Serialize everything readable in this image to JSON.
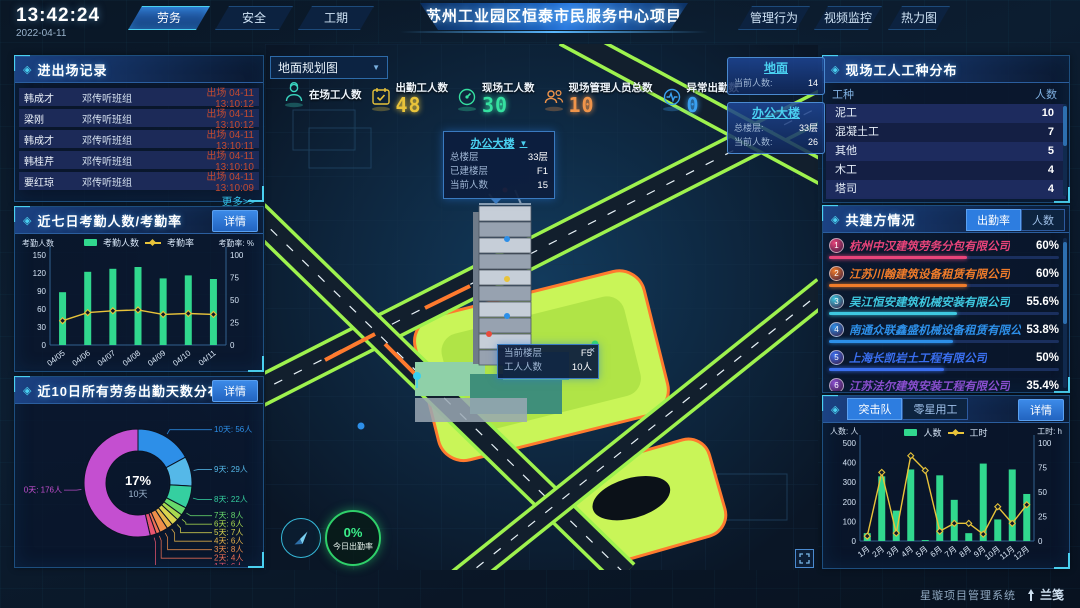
{
  "topbar": {
    "time": "13:42:24",
    "date": "2022-04-11",
    "left_tabs": [
      {
        "label": "劳务",
        "active": true
      },
      {
        "label": "安全",
        "active": false
      },
      {
        "label": "工期",
        "active": false
      }
    ],
    "title": "苏州工业园区恒泰市民服务中心项目",
    "right_tabs": [
      "管理行为",
      "视频监控",
      "热力图"
    ]
  },
  "entry_exit": {
    "title": "进出场记录",
    "more_label": "更多>>",
    "rows": [
      {
        "name": "韩成才",
        "group": "邓传听班组",
        "event": "出场 04-11 13:10:12"
      },
      {
        "name": "梁刚",
        "group": "邓传听班组",
        "event": "出场 04-11 13:10:12"
      },
      {
        "name": "韩成才",
        "group": "邓传听班组",
        "event": "出场 04-11 13:10:11"
      },
      {
        "name": "韩桂芹",
        "group": "邓传听班组",
        "event": "出场 04-11 13:10:10"
      },
      {
        "name": "要红琼",
        "group": "邓传听班组",
        "event": "出场 04-11 13:10:09"
      }
    ]
  },
  "panels": {
    "attendance": {
      "title": "近七日考勤人数/考勤率",
      "detail": "详情"
    },
    "distribution": {
      "title": "近10日所有劳务出勤天数分布",
      "detail": "详情"
    }
  },
  "map": {
    "layer_select": "地面规划图",
    "stats": [
      {
        "label": "在场工人数",
        "value": "",
        "color": "#3ad6c0",
        "icon": "worker-icon"
      },
      {
        "label": "出勤工人数",
        "value": "48",
        "color": "#e8c33a",
        "icon": "calendar-icon"
      },
      {
        "label": "现场工人数",
        "value": "30",
        "color": "#35e0a0",
        "icon": "gauge-icon"
      },
      {
        "label": "现场管理人员总数",
        "value": "10",
        "color": "#f0944a",
        "icon": "people-icon"
      },
      {
        "label": "异常出勤数",
        "value": "0",
        "color": "#3aa0f0",
        "icon": "pulse-icon"
      }
    ],
    "building_tooltip": {
      "title": "办公大楼",
      "rows": [
        [
          "总楼层",
          "33层"
        ],
        [
          "已建楼层",
          "F1"
        ],
        [
          "当前人数",
          "15"
        ]
      ]
    },
    "floor_tooltip": {
      "close": "×",
      "rows": [
        [
          "当前楼层",
          "F5"
        ],
        [
          "工人人数",
          "10人"
        ]
      ]
    },
    "cards": [
      {
        "title": "地面",
        "rows": [
          [
            "当前人数:",
            "14"
          ]
        ]
      },
      {
        "title": "办公大楼",
        "rows": [
          [
            "总楼层:",
            "33层"
          ],
          [
            "当前人数:",
            "26"
          ]
        ]
      }
    ],
    "attendance_ring": {
      "value": "0%",
      "label": "今日出勤率"
    }
  },
  "trade_panel": {
    "title": "现场工人工种分布",
    "headers": [
      "工种",
      "人数"
    ],
    "rows": [
      [
        "泥工",
        "10"
      ],
      [
        "混凝土工",
        "7"
      ],
      [
        "其他",
        "5"
      ],
      [
        "木工",
        "4"
      ],
      [
        "塔司",
        "4"
      ]
    ]
  },
  "partners_panel": {
    "title": "共建方情况",
    "tabs": [
      "出勤率",
      "人数"
    ],
    "active_tab": 0,
    "companies": [
      {
        "rank": "1",
        "name": "杭州中汉建筑劳务分包有限公司",
        "value": "60%",
        "pct": 60,
        "color": "#e8447a"
      },
      {
        "rank": "2",
        "name": "江苏川翰建筑设备租赁有限公司",
        "value": "60%",
        "pct": 60,
        "color": "#f07c2a"
      },
      {
        "rank": "3",
        "name": "吴江恒安建筑机械安装有限公司",
        "value": "55.6%",
        "pct": 55.6,
        "color": "#3ec8e0"
      },
      {
        "rank": "4",
        "name": "南通众联鑫盛机械设备租赁有限公司",
        "value": "53.8%",
        "pct": 53.8,
        "color": "#2d8fe8"
      },
      {
        "rank": "5",
        "name": "上海长凯岩土工程有限公司",
        "value": "50%",
        "pct": 50,
        "color": "#3a6ff0"
      },
      {
        "rank": "6",
        "name": "江苏法尔建筑安装工程有限公司",
        "value": "35.4%",
        "pct": 35.4,
        "color": "#8a4fd0"
      }
    ]
  },
  "squad_panel": {
    "tabs": [
      "突击队",
      "零星用工"
    ],
    "active_tab": 0,
    "detail": "详情"
  },
  "chart_data": [
    {
      "type": "bar+line",
      "title": "近七日考勤人数/考勤率",
      "categories": [
        "04/05",
        "04/06",
        "04/07",
        "04/08",
        "04/09",
        "04/10",
        "04/11"
      ],
      "series": [
        {
          "name": "考勤人数",
          "type": "bar",
          "color": "#31d88e",
          "axis": "left",
          "values": [
            88,
            122,
            127,
            130,
            111,
            116,
            110
          ]
        },
        {
          "name": "考勤率",
          "type": "line",
          "color": "#e8c33a",
          "axis": "right",
          "values": [
            27,
            36,
            38,
            39,
            34,
            35,
            34
          ]
        }
      ],
      "left_axis": {
        "label": "考勤人数",
        "min": 0,
        "max": 150,
        "step": 30
      },
      "right_axis": {
        "label": "考勤率: %",
        "min": 0,
        "max": 100,
        "step": 25
      },
      "legend_position": "top"
    },
    {
      "type": "pie",
      "title": "近10日所有劳务出勤天数分布",
      "slices": [
        {
          "label": "10天",
          "value": 56,
          "display": "10天: 56人",
          "color": "#2d8fe8"
        },
        {
          "label": "9天",
          "value": 29,
          "display": "9天: 29人",
          "color": "#55b8e8"
        },
        {
          "label": "8天",
          "value": 22,
          "display": "8天: 22人",
          "color": "#35cfa0"
        },
        {
          "label": "7天",
          "value": 8,
          "display": "7天: 8人",
          "color": "#67d96b"
        },
        {
          "label": "6天",
          "value": 6,
          "display": "6天: 6人",
          "color": "#a8d94f"
        },
        {
          "label": "5天",
          "value": 7,
          "display": "5天: 7人",
          "color": "#d9d44f"
        },
        {
          "label": "4天",
          "value": 6,
          "display": "4天: 6人",
          "color": "#e8b44a"
        },
        {
          "label": "3天",
          "value": 8,
          "display": "3天: 8人",
          "color": "#ef8f4a"
        },
        {
          "label": "2天",
          "value": 4,
          "display": "2天: 4人",
          "color": "#ef6f55"
        },
        {
          "label": "1天",
          "value": 6,
          "display": "1天: 6人",
          "color": "#e85570"
        },
        {
          "label": "0天",
          "value": 176,
          "display": "0天: 176人",
          "color": "#c44fd0"
        }
      ],
      "center": {
        "pct": "17%",
        "label": "10天"
      }
    },
    {
      "type": "bar+line",
      "title": "突击队",
      "categories": [
        "1月",
        "2月",
        "3月",
        "4月",
        "5月",
        "6月",
        "7月",
        "8月",
        "9月",
        "10月",
        "11月",
        "12月"
      ],
      "series": [
        {
          "name": "人数",
          "type": "bar",
          "color": "#31d88e",
          "axis": "left",
          "values": [
            40,
            330,
            155,
            365,
            5,
            335,
            210,
            40,
            395,
            110,
            365,
            240
          ]
        },
        {
          "name": "工时",
          "type": "line",
          "color": "#e8c33a",
          "axis": "right",
          "values": [
            5,
            70,
            8,
            87,
            72,
            10,
            18,
            18,
            7,
            35,
            18,
            37
          ]
        }
      ],
      "left_axis": {
        "label": "人数: 人",
        "min": 0,
        "max": 500,
        "step": 100
      },
      "right_axis": {
        "label": "工时: h",
        "min": 0,
        "max": 100,
        "step": 25
      },
      "legend_position": "top"
    }
  ],
  "footer": {
    "system_name": "星璇项目管理系统",
    "logo_text": "兰笺"
  }
}
